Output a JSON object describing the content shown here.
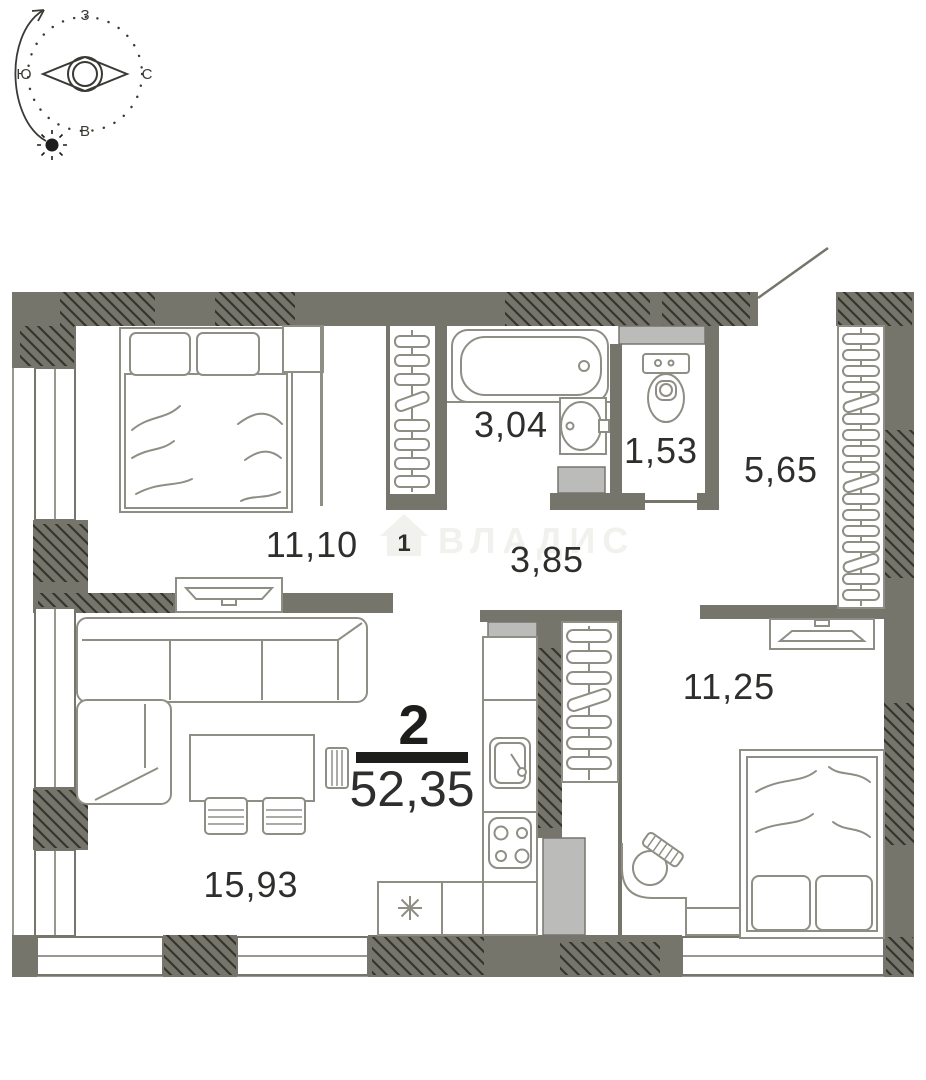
{
  "meta": {
    "watermark": "ВЛАДИС",
    "type_label": "floor-plan"
  },
  "compass": {
    "top": "З",
    "right": "С",
    "bottom": "В",
    "left": "Ю"
  },
  "apartment": {
    "rooms_count": "2",
    "total_area": "52,35"
  },
  "rooms": [
    {
      "id": "bedroom-1",
      "area": "11,10"
    },
    {
      "id": "bathroom",
      "area": "3,04"
    },
    {
      "id": "wc",
      "area": "1,53"
    },
    {
      "id": "hallway",
      "area": "5,65"
    },
    {
      "id": "corridor",
      "area": "3,85"
    },
    {
      "id": "bedroom-2",
      "area": "11,25"
    },
    {
      "id": "living-kitchen",
      "area": "15,93"
    }
  ],
  "colors": {
    "wall": "#76756c",
    "shaft": "#bbbbba",
    "furniture_line": "#8f8e85",
    "hatch": "#35352e",
    "text": "#2e2e2c",
    "accent": "#1d1d1b",
    "watermark": "#f1f1ee"
  }
}
